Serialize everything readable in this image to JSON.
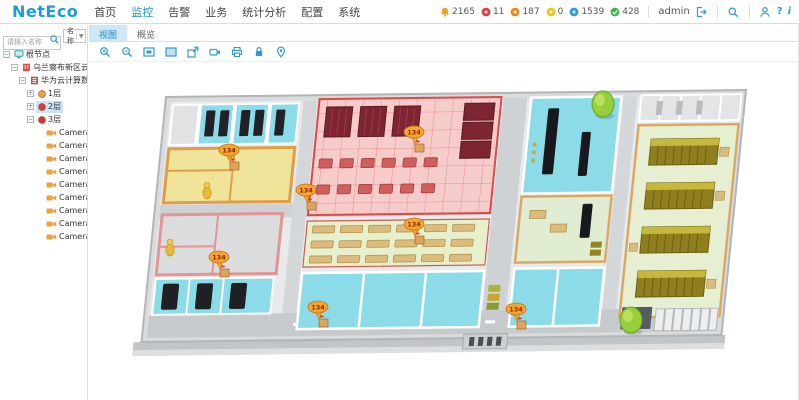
{
  "header": {
    "logo": "NetEco",
    "menu": [
      {
        "label": "首页",
        "active": false
      },
      {
        "label": "监控",
        "active": true
      },
      {
        "label": "告警",
        "active": false
      },
      {
        "label": "业务",
        "active": false
      },
      {
        "label": "统计分析",
        "active": false
      },
      {
        "label": "配置",
        "active": false
      },
      {
        "label": "系统",
        "active": false
      }
    ],
    "alarms": [
      {
        "name": "total",
        "icon": "bell",
        "color": "#e8a225",
        "count": "2165"
      },
      {
        "name": "critical",
        "icon": "dot",
        "color": "#e23b3b",
        "count": "11"
      },
      {
        "name": "major",
        "icon": "dot",
        "color": "#f08519",
        "count": "187"
      },
      {
        "name": "minor",
        "icon": "dot",
        "color": "#f0c419",
        "count": "0"
      },
      {
        "name": "warning",
        "icon": "dot",
        "color": "#2e9bd6",
        "count": "1539"
      },
      {
        "name": "cleared",
        "icon": "check",
        "color": "#3cb44a",
        "count": "428"
      }
    ],
    "user": "admin"
  },
  "sidebar": {
    "search_placeholder": "请输入名称",
    "filter_label": "名称",
    "tree": [
      {
        "label": "根节点",
        "level": 0,
        "icon": "root",
        "expander": "-"
      },
      {
        "label": "乌兰察布新区云计算",
        "level": 1,
        "icon": "site",
        "expander": "-"
      },
      {
        "label": "华为云计算数据中心",
        "level": 2,
        "icon": "dc",
        "expander": "-"
      },
      {
        "label": "1层",
        "level": 3,
        "icon": "floor",
        "color": "#f0a23a",
        "expander": "+"
      },
      {
        "label": "2层",
        "level": 3,
        "icon": "floor",
        "color": "#e23b3b",
        "expander": "+",
        "selected": true
      },
      {
        "label": "3层",
        "level": 3,
        "icon": "floor",
        "color": "#d83030",
        "expander": "-"
      },
      {
        "label": "Camera1",
        "level": 4,
        "icon": "camera"
      },
      {
        "label": "Camera2",
        "level": 4,
        "icon": "camera"
      },
      {
        "label": "Camera3",
        "level": 4,
        "icon": "camera"
      },
      {
        "label": "Camera4",
        "level": 4,
        "icon": "camera"
      },
      {
        "label": "Camera5",
        "level": 4,
        "icon": "camera"
      },
      {
        "label": "Camera6",
        "level": 4,
        "icon": "camera"
      },
      {
        "label": "Camera7",
        "level": 4,
        "icon": "camera"
      },
      {
        "label": "Camera8",
        "level": 4,
        "icon": "camera"
      },
      {
        "label": "Camera9",
        "level": 4,
        "icon": "camera"
      }
    ]
  },
  "main": {
    "tabs": [
      {
        "label": "视图",
        "active": true
      },
      {
        "label": "概览",
        "active": false
      }
    ],
    "toolbar": [
      {
        "name": "zoom-in"
      },
      {
        "name": "zoom-out"
      },
      {
        "name": "fit-view"
      },
      {
        "name": "fullscreen"
      },
      {
        "name": "export"
      },
      {
        "name": "video"
      },
      {
        "name": "print"
      },
      {
        "name": "lock"
      },
      {
        "name": "locate"
      }
    ],
    "floorplan": {
      "accent_colors": {
        "toolbar_blue": "#2e9bd6",
        "alarm_orange": "#f7a52c"
      },
      "markers": [
        {
          "label": "134",
          "x": 132,
          "y": 88
        },
        {
          "label": "134",
          "x": 209,
          "y": 128
        },
        {
          "label": "134",
          "x": 317,
          "y": 70
        },
        {
          "label": "134",
          "x": 122,
          "y": 195
        },
        {
          "label": "134",
          "x": 221,
          "y": 245
        },
        {
          "label": "134",
          "x": 317,
          "y": 162
        },
        {
          "label": "134",
          "x": 419,
          "y": 247
        }
      ],
      "figures": [
        {
          "x": 110,
          "y": 124
        },
        {
          "x": 73,
          "y": 181
        }
      ],
      "trees": [
        {
          "x": 506,
          "y": 42
        },
        {
          "x": 534,
          "y": 258
        }
      ]
    }
  }
}
